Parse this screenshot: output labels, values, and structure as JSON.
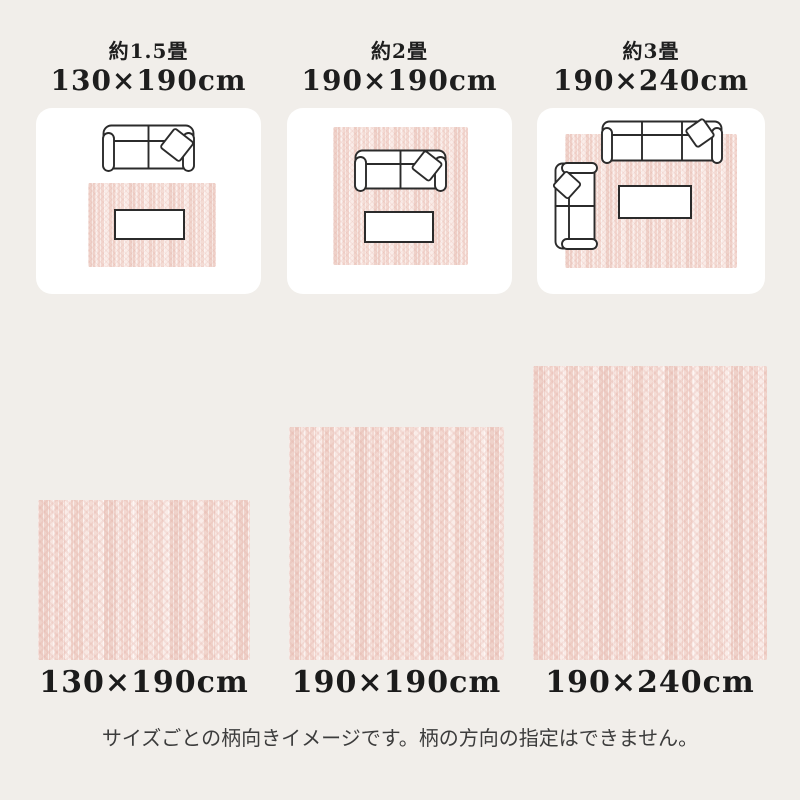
{
  "page": {
    "background_color": "#f1eeea",
    "caption": "サイズごとの柄向きイメージです。柄の方向の指定はできません。"
  },
  "layout_section": {
    "cards": [
      {
        "tatami": "約1.5畳",
        "dimensions": "130×190cm"
      },
      {
        "tatami": "約2畳",
        "dimensions": "190×190cm"
      },
      {
        "tatami": "約3畳",
        "dimensions": "190×240cm"
      }
    ]
  },
  "swatch_section": {
    "swatches": [
      {
        "label": "130×190cm"
      },
      {
        "label": "190×190cm"
      },
      {
        "label": "190×240cm"
      }
    ]
  },
  "icons": {
    "sofa_2seat": "top-view two-seat sofa outline with tilted cushion",
    "sofa_3seat": "top-view three-seat sofa outline with tilted cushion",
    "sofa_2seat_vertical": "top-view two-seat sofa rotated 90°, back at left",
    "low_table": "rectangular low table outline",
    "rug_swatch": "pink cable-knit rug"
  },
  "colors": {
    "card_background": "#ffffff",
    "rug_base": "#f8e9e5",
    "rug_pattern": "#efd2ca",
    "furniture_outline": "#2b2b2b",
    "heading_text": "#1e1e1e",
    "caption_text": "#3c3c3c"
  }
}
